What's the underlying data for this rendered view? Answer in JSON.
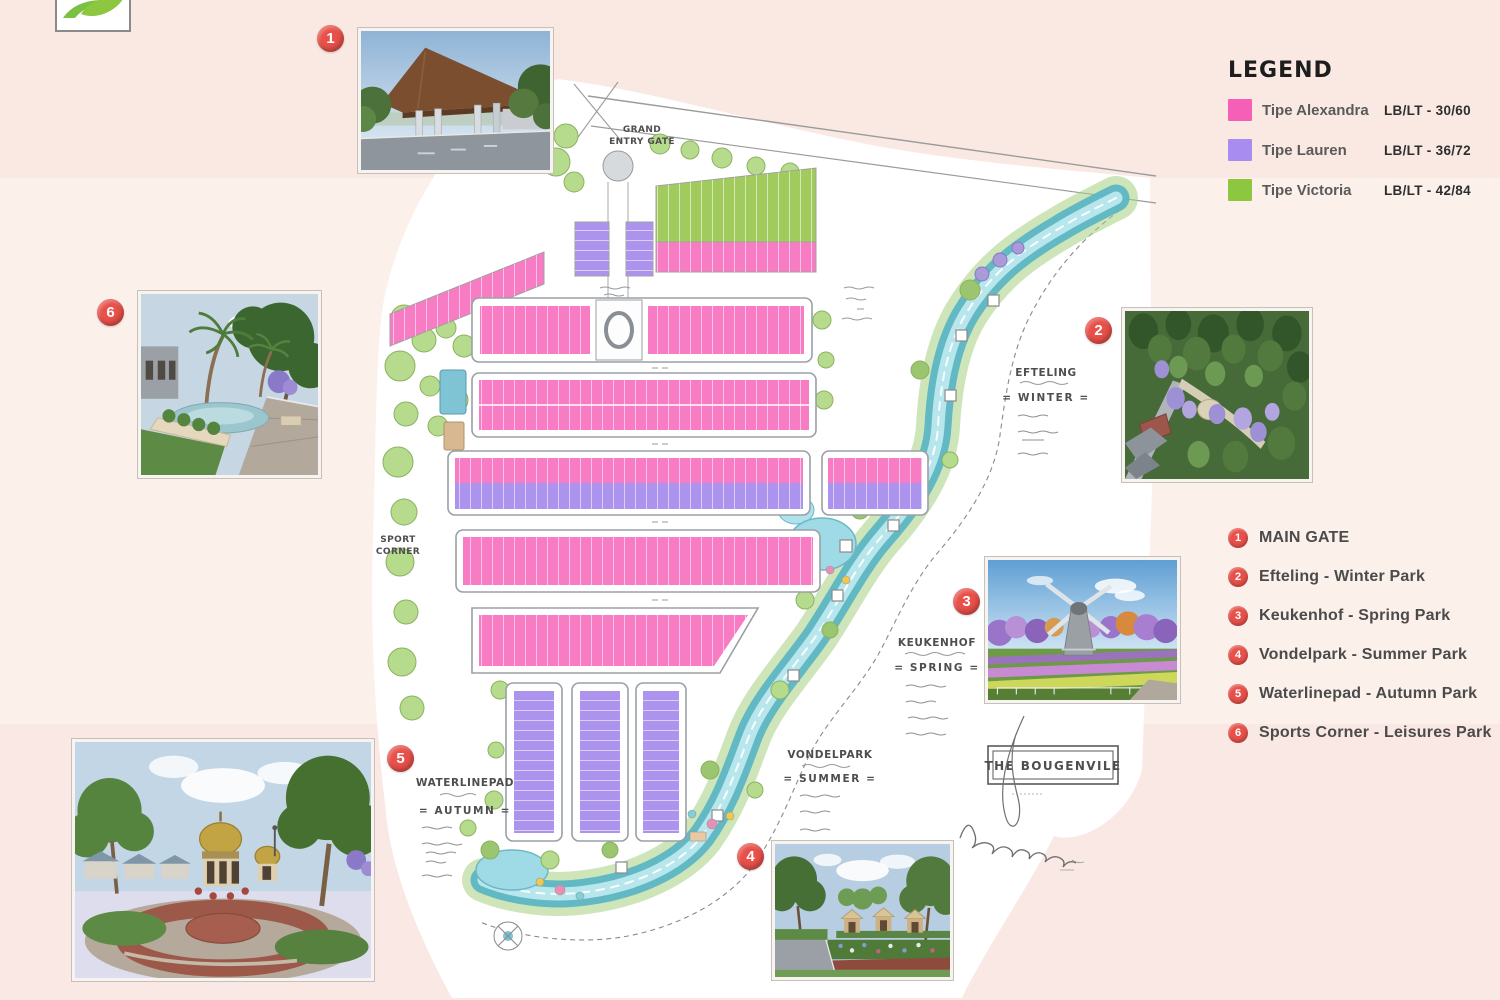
{
  "page": {
    "background": "#fbede8"
  },
  "legend": {
    "title": "LEGEND",
    "items": [
      {
        "label": "Tipe Alexandra",
        "value": "LB/LT - 30/60",
        "color": "#f55fb5"
      },
      {
        "label": "Tipe Lauren",
        "value": "LB/LT - 36/72",
        "color": "#a88cf0"
      },
      {
        "label": "Tipe Victoria",
        "value": "LB/LT - 42/84",
        "color": "#8dc63f"
      }
    ]
  },
  "locations": {
    "marker_color": "#e8504a",
    "items": [
      {
        "number": "1",
        "label": "MAIN GATE"
      },
      {
        "number": "2",
        "label": "Efteling - Winter Park"
      },
      {
        "number": "3",
        "label": "Keukenhof - Spring Park"
      },
      {
        "number": "4",
        "label": "Vondelpark - Summer Park"
      },
      {
        "number": "5",
        "label": "Waterlinepad - Autumn Park"
      },
      {
        "number": "6",
        "label": "Sports Corner - Leisures Park"
      }
    ]
  },
  "map": {
    "entry_gate_line1": "GRAND",
    "entry_gate_line2": "ENTRY GATE",
    "sport_corner_line1": "SPORT",
    "sport_corner_line2": "CORNER",
    "parks": {
      "efteling": {
        "title": "EFTELING",
        "season": "= WINTER ="
      },
      "keukenhof": {
        "title": "KEUKENHOF",
        "season": "= SPRING ="
      },
      "vondelpark": {
        "title": "VONDELPARK",
        "season": "= SUMMER ="
      },
      "waterlinepad": {
        "title": "WATERLINEPAD",
        "season": "= AUTUMN ="
      }
    },
    "project_name": "THE BOUGENVILE",
    "house_colors": {
      "alexandra": "#f87cc4",
      "lauren": "#ab93ee",
      "victoria": "#a2cb5e"
    }
  }
}
